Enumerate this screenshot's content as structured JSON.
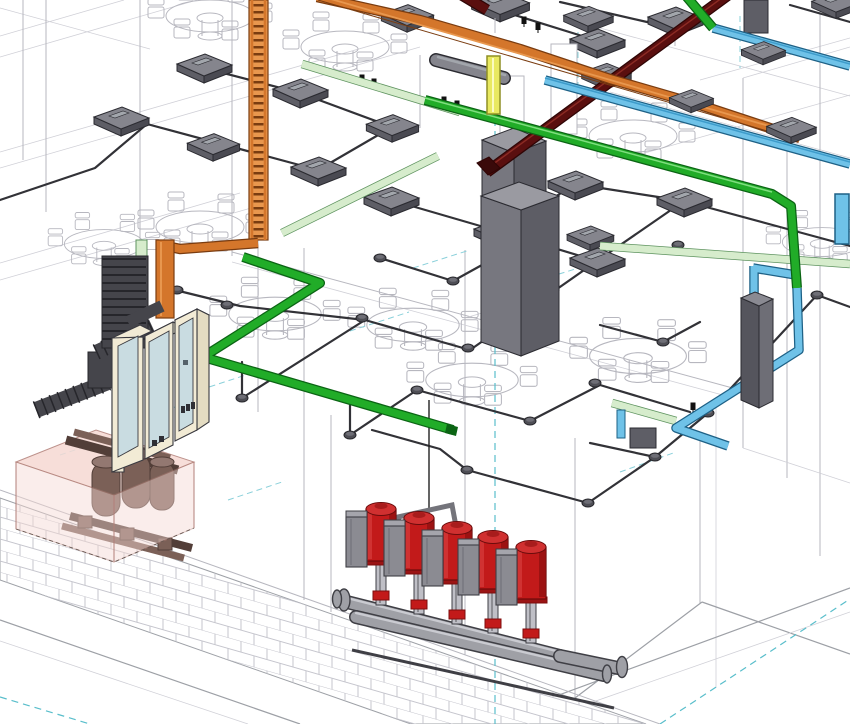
{
  "view": {
    "app": "BIM 3D view",
    "type": "3d-isometric",
    "description": "Isometric MEP coordination view: cable trays, conduit network with junction boxes, ceiling fixtures, LV switchboard, transformer room and booster pump set over a brick wall"
  },
  "counts": {
    "pumps": 5,
    "switchboard_sections": 3,
    "tables": 10,
    "ceiling_boxes": 22
  },
  "systems": [
    {
      "name": "power-cable-tray",
      "color": "#D4762B"
    },
    {
      "name": "lighting-conduit-run",
      "color": "#21AC28"
    },
    {
      "name": "telecom-cable-tray",
      "color": "#6FC2E8"
    },
    {
      "name": "busduct",
      "color": "#5A0F0F"
    },
    {
      "name": "secondary-pale-tray",
      "color": "#D6ECCC"
    },
    {
      "name": "vertical-feeder",
      "color": "#E9E960"
    },
    {
      "name": "main-switchboard",
      "color": "#F2EBD5"
    },
    {
      "name": "transformer",
      "color": "#7B6057"
    },
    {
      "name": "transformer-room-volume",
      "color": "#F6D9D3"
    },
    {
      "name": "booster-pump-set",
      "color": "#C21A1A"
    },
    {
      "name": "ceiling-junction-boxes",
      "color": "#85858D"
    },
    {
      "name": "conduit-network",
      "color": "#323237"
    },
    {
      "name": "reference-grid",
      "color": "#59BECB"
    },
    {
      "name": "structure-furniture-wireframe",
      "color": "#B7B7BF"
    }
  ],
  "colors": {
    "wireframe": "#B7B7BF",
    "wireframe_light": "#D0D0D7",
    "floor_edge": "#9DA0A6",
    "brick": "#C5C5CD",
    "grid_cyan": "#59BECB",
    "grid_cyan_soft": "#8AD0DA",
    "conduit": "#323237",
    "puck": "#4E4E55",
    "puck_top": "#6E6E76",
    "box_top": "#85858D",
    "box_side_l": "#5E5E66",
    "box_side_r": "#4A4A52",
    "box_edge": "#2B2B31",
    "box_slot": "#A2A6AC",
    "tray_orange": "#D4762B",
    "tray_orange_light": "#E8974E",
    "tray_orange_dark": "#7A3C10",
    "green": "#21AC28",
    "green_dark": "#0B6414",
    "green_light": "#7FDE7F",
    "pale_green": "#D6ECCC",
    "pale_green_edge": "#5E935F",
    "blue": "#6FC2E8",
    "blue_mid": "#3E9CCB",
    "blue_dark": "#1E6186",
    "busduct": "#5A0F0F",
    "busduct_edge": "#2F0505",
    "busduct_hl": "#8C2B24",
    "yellow": "#E9E960",
    "yellow_edge": "#8F8F25",
    "cabinet_top": "#9A9AA1",
    "cabinet_left": "#77777F",
    "cabinet_right": "#5D5D65",
    "panel_cream": "#F2EBD5",
    "panel_cream_dark": "#E4DCC2",
    "panel_door": "#C9DCE1",
    "panel_edge": "#3A3A40",
    "busway": "#45454B",
    "busway_dark": "#26262B",
    "room_pink": "#F6D9D3",
    "room_pink_edge": "#B27F78",
    "xfmr": "#7B6057",
    "xfmr_dark": "#523E38",
    "xfmr_light": "#937871",
    "pump_red": "#C21A1A",
    "pump_red_dark": "#7D0D0D",
    "pump_red_light": "#DD4A4A",
    "pump_gray": "#8B8B92",
    "pump_gray_light": "#A5A5AC",
    "pipe": "#9FA0A6",
    "pipe_dark": "#3F3F45",
    "pipe_light": "#CACBD1"
  }
}
